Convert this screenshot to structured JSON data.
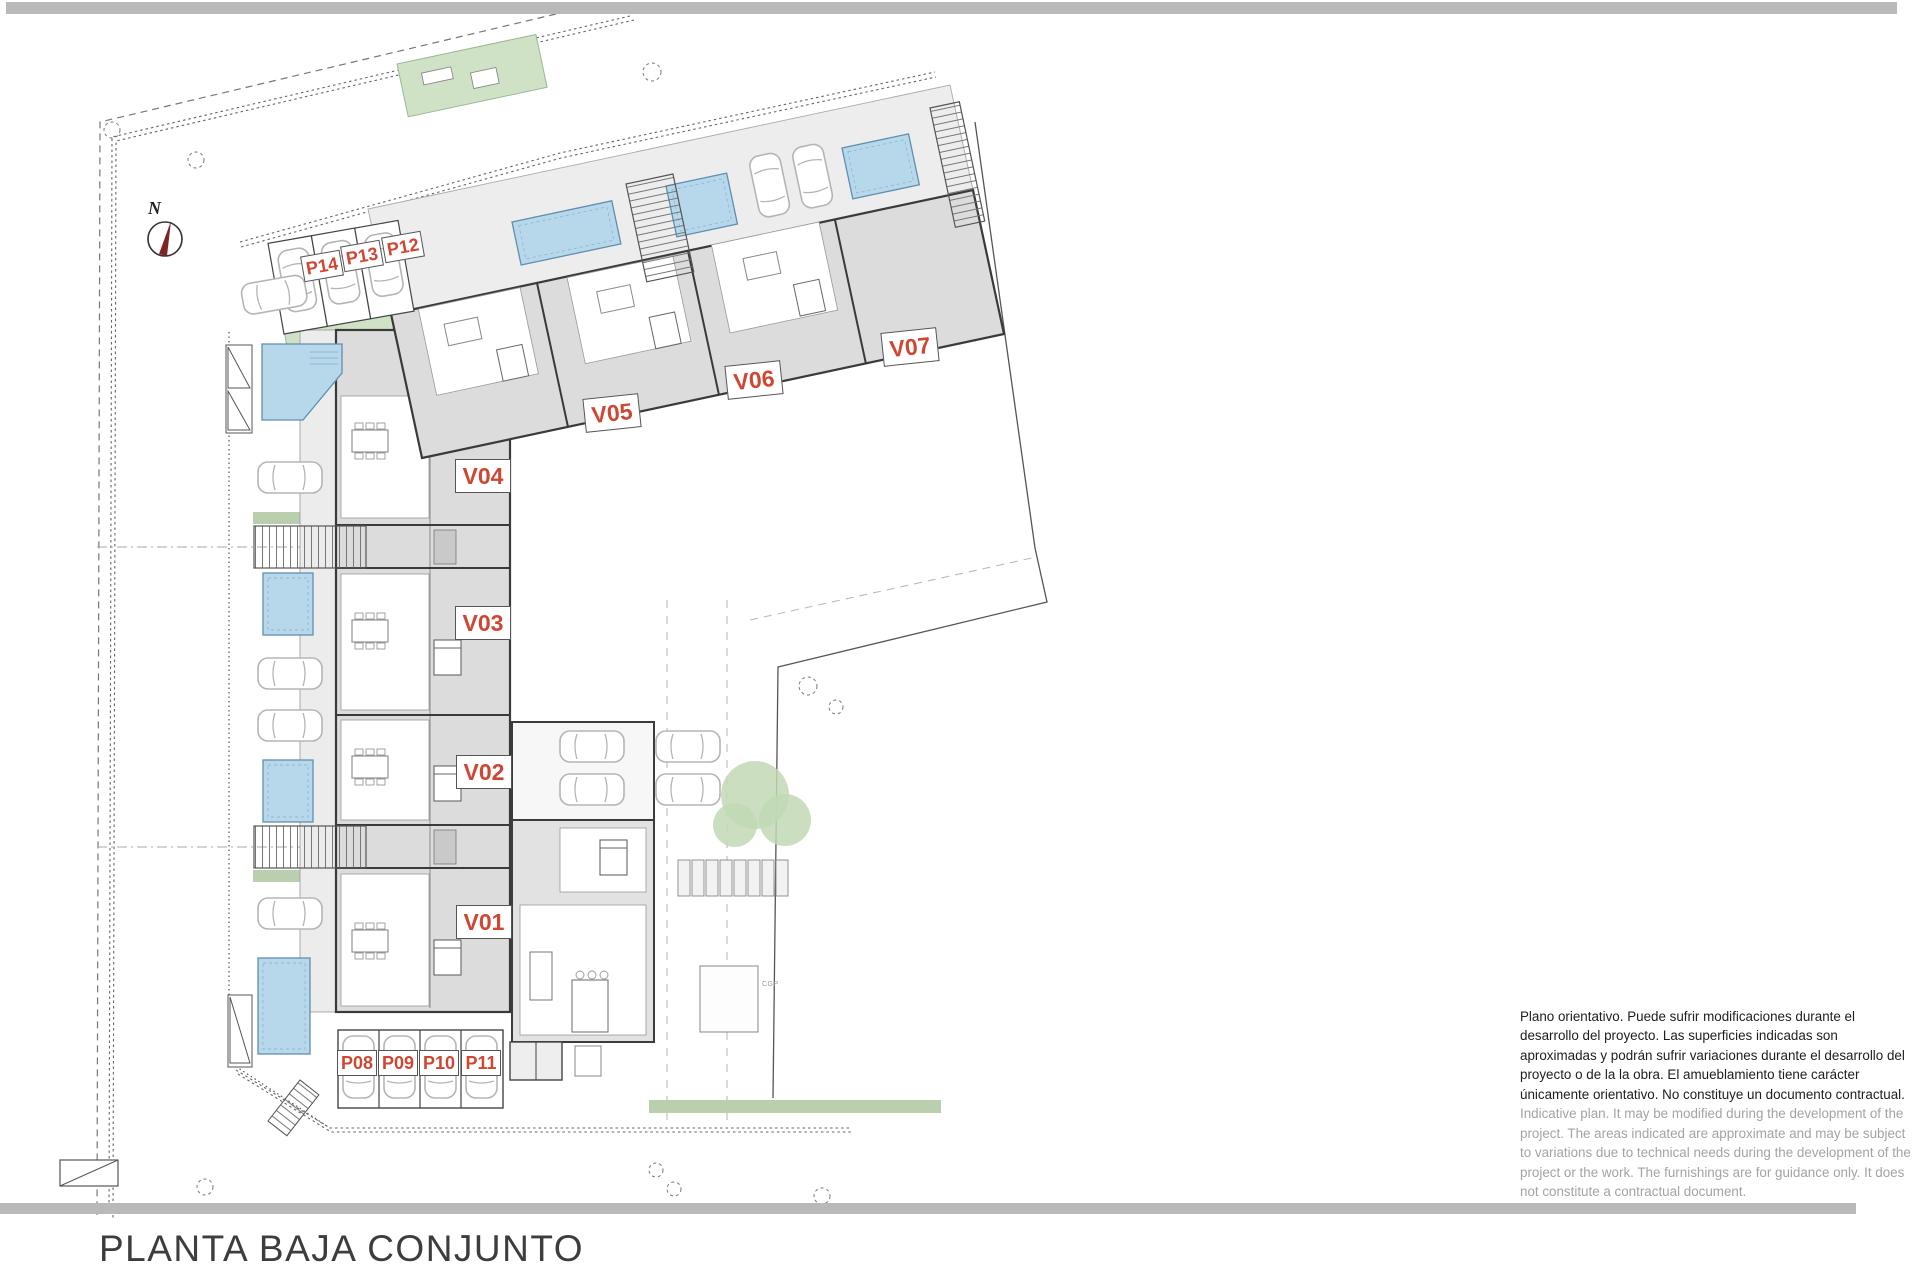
{
  "title": "PLANTA BAJA CONJUNTO",
  "compass": {
    "label": "N"
  },
  "plan": {
    "units": [
      {
        "label": "V01"
      },
      {
        "label": "V02"
      },
      {
        "label": "V03"
      },
      {
        "label": "V04"
      },
      {
        "label": "V05"
      },
      {
        "label": "V06"
      },
      {
        "label": "V07"
      }
    ],
    "parking": [
      {
        "label": "P08"
      },
      {
        "label": "P09"
      },
      {
        "label": "P10"
      },
      {
        "label": "P11"
      },
      {
        "label": "P12"
      },
      {
        "label": "P13"
      },
      {
        "label": "P14"
      }
    ],
    "annotations": {
      "cgp": "CGP"
    },
    "colors": {
      "label_red": "#cf4733",
      "pool_blue": "#b7d8eb",
      "garden_green": "#cfe2c6",
      "bar_gray": "#b9b9b9",
      "wall_dark": "#3a3a3a"
    }
  },
  "disclaimer": {
    "es": "Plano orientativo. Puede sufrir modificaciones durante el desarrollo del proyecto. Las superficies indicadas son aproximadas y podrán sufrir variaciones durante el desarrollo del proyecto o de la la obra. El amueblamiento tiene carácter únicamente orientativo. No constituye un documento contractual.",
    "en": "Indicative plan. It may be modified during the development of the project. The areas indicated are approximate and may be subject to variations due to technical needs during the development of the project or the work. The furnishings are for guidance only. It does not constitute a contractual document."
  }
}
